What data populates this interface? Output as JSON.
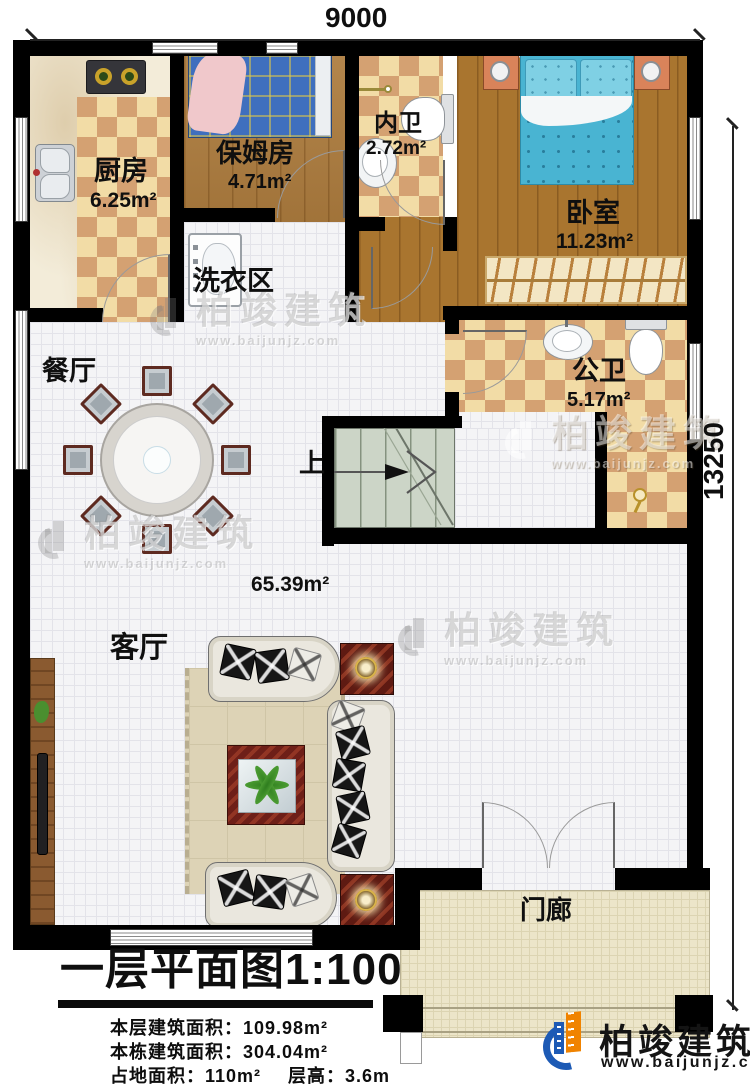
{
  "plan": {
    "title": "一层平面图1:100",
    "dimensions": {
      "top": "9000",
      "right": "13250"
    },
    "rooms": {
      "kitchen": {
        "name": "厨房",
        "area": "6.25m²"
      },
      "nanny_room": {
        "name": "保姆房",
        "area": "4.71m²"
      },
      "inner_bathroom": {
        "name": "内卫",
        "area": "2.72m²"
      },
      "bedroom": {
        "name": "卧室",
        "area": "11.23m²"
      },
      "laundry_area": {
        "name": "洗衣区"
      },
      "dining_room": {
        "name": "餐厅"
      },
      "public_bathroom": {
        "name": "公卫",
        "area": "5.17m²"
      },
      "living_room": {
        "name": "客厅",
        "area": "65.39m²"
      },
      "porch": {
        "name": "门廊"
      },
      "stairs": {
        "direction_label": "上"
      }
    },
    "stats": {
      "floor_area": {
        "label": "本层建筑面积：",
        "value": "109.98m²"
      },
      "building_area": {
        "label": "本栋建筑面积：",
        "value": "304.04m²"
      },
      "footprint": {
        "label": "占地面积：",
        "value": "110m²"
      },
      "floor_height": {
        "label": "层高：",
        "value": "3.6m"
      }
    }
  },
  "branding": {
    "company": "柏竣建筑",
    "website": "www.baijunjz.com"
  },
  "colors": {
    "wall": "#000000",
    "checker_light": "#f2dca6",
    "checker_dark": "#d4a172",
    "wood": "#ad7c3e",
    "stair": "#ccd5c7",
    "porch": "#ece5c9",
    "logo_blue": "#1d5ab5",
    "logo_orange": "#f08300"
  }
}
